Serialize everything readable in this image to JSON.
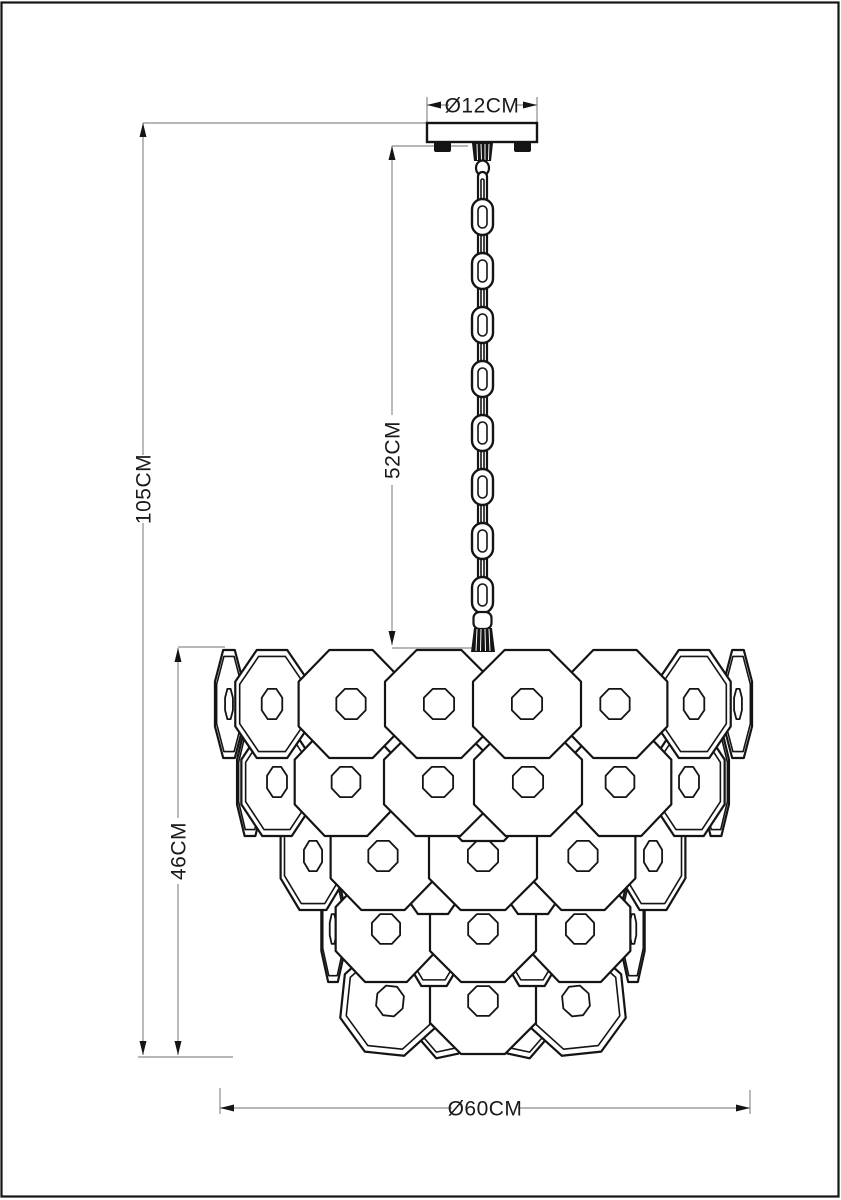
{
  "drawing": {
    "title": "chandelier-dimension-drawing",
    "labels": {
      "canopy_diameter": "Ø12CM",
      "hanging_length": "52CM",
      "total_height": "105CM",
      "body_height": "46CM",
      "body_diameter": "Ø60CM"
    },
    "colors": {
      "outline": "#141414",
      "dim_line": "#8c8c8c",
      "text": "#1a1a1a",
      "background": "#ffffff"
    },
    "figure": {
      "center_x": 482.5,
      "chain": {
        "x": 482.5,
        "top": 172,
        "pitch": 27,
        "count": 16,
        "link_h": 36,
        "wide_w": 21,
        "narrow_w": 9
      },
      "hole_ratio": 0.28,
      "rows": [
        {
          "y": 1007,
          "r": 50,
          "discs": [
            {
              "x": 437,
              "sx": 0.55,
              "rot": -12,
              "rim": true
            },
            {
              "x": 529,
              "sx": 0.55,
              "rot": 12,
              "rim": true
            }
          ]
        },
        {
          "y": 1001,
          "r": 53,
          "discs": [
            {
              "x": 390,
              "sx": 0.9,
              "rot": 6,
              "rim": true
            },
            {
              "x": 576,
              "sx": 0.9,
              "rot": -6,
              "rim": true
            },
            {
              "x": 483,
              "sx": 1
            }
          ]
        },
        {
          "y": 935,
          "r": 51,
          "discs": [
            {
              "x": 434,
              "sx": 0.6,
              "rim": true
            },
            {
              "x": 532,
              "sx": 0.6,
              "rim": true
            }
          ]
        },
        {
          "y": 929,
          "r": 53,
          "discs": [
            {
              "x": 333,
              "sx": 0.22,
              "rim": true
            },
            {
              "x": 633,
              "sx": 0.22,
              "rim": true
            },
            {
              "x": 386,
              "sx": 0.95
            },
            {
              "x": 580,
              "sx": 0.95
            },
            {
              "x": 483,
              "sx": 1
            }
          ]
        },
        {
          "y": 862,
          "r": 52,
          "discs": [
            {
              "x": 433,
              "sx": 0.7
            },
            {
              "x": 533,
              "sx": 0.7
            }
          ]
        },
        {
          "y": 856,
          "r": 54,
          "discs": [
            {
              "x": 313,
              "sx": 0.6,
              "rim": true
            },
            {
              "x": 653,
              "sx": 0.6,
              "rim": true
            },
            {
              "x": 383,
              "sx": 0.97
            },
            {
              "x": 583,
              "sx": 0.97
            },
            {
              "x": 483,
              "sx": 1
            }
          ]
        },
        {
          "y": 788,
          "r": 53,
          "discs": [
            {
              "x": 483,
              "sx": 0.95
            }
          ]
        },
        {
          "y": 782,
          "r": 54,
          "discs": [
            {
              "x": 250,
              "sx": 0.24,
              "rim": true
            },
            {
              "x": 716,
              "sx": 0.24,
              "rim": true
            },
            {
              "x": 277,
              "sx": 0.66,
              "rim": true
            },
            {
              "x": 689,
              "sx": 0.66,
              "rim": true
            },
            {
              "x": 346,
              "sx": 0.95
            },
            {
              "x": 620,
              "sx": 0.95
            },
            {
              "x": 438,
              "sx": 1
            },
            {
              "x": 528,
              "sx": 1
            }
          ]
        },
        {
          "y": 704,
          "r": 54,
          "discs": [
            {
              "x": 229,
              "sx": 0.26,
              "rim": true
            },
            {
              "x": 738,
              "sx": 0.26,
              "rim": true
            },
            {
              "x": 272,
              "sx": 0.68,
              "rim": true
            },
            {
              "x": 694,
              "sx": 0.68,
              "rim": true
            },
            {
              "x": 351,
              "sx": 0.97
            },
            {
              "x": 615,
              "sx": 0.97
            },
            {
              "x": 439,
              "sx": 1
            },
            {
              "x": 527,
              "sx": 1
            }
          ]
        }
      ]
    }
  }
}
